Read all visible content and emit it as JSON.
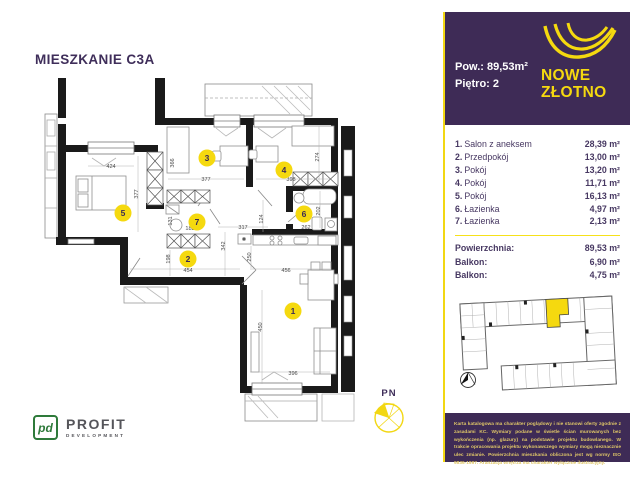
{
  "title": "MIESZKANIE C3A",
  "panel": {
    "header": {
      "area_line": "Pow.: 89,53m²",
      "floor_line": "Piętro: 2",
      "brand_line1": "NOWE",
      "brand_line2": "ZŁOTNO"
    },
    "rooms": [
      {
        "num": "1.",
        "name": "Salon z aneksem",
        "area": "28,39 m²"
      },
      {
        "num": "2.",
        "name": "Przedpokój",
        "area": "13,00 m²"
      },
      {
        "num": "3.",
        "name": "Pokój",
        "area": "13,20 m²"
      },
      {
        "num": "4.",
        "name": "Pokój",
        "area": "11,71 m²"
      },
      {
        "num": "5.",
        "name": "Pokój",
        "area": "16,13 m²"
      },
      {
        "num": "6.",
        "name": "Łazienka",
        "area": "4,97 m²"
      },
      {
        "num": "7.",
        "name": "Łazienka",
        "area": "2,13 m²"
      }
    ],
    "summary": [
      {
        "label": "Powierzchnia:",
        "value": "89,53 m²"
      },
      {
        "label": "Balkon:",
        "value": "6,90 m²"
      },
      {
        "label": "Balkon:",
        "value": "4,75 m²"
      }
    ],
    "disclaimer": "Karta katalogowa ma charakter poglądowy i nie stanowi oferty zgodnie z zasadami KC. Wymiary podane w świetle ścian murowanych bez wykończenia (np. glazury) na podstawie projektu budowlanego. W trakcie opracowania projektu wykonawczego wymiary mogą nieznacznie ulec zmianie. Powierzchnia mieszkania obliczona jest wg normy ISO 9836-1997. Aranżacja wnętrza ma charakter wyłącznie ilustracyjny."
  },
  "plan": {
    "room_markers": [
      {
        "n": "1",
        "x": 293,
        "y": 311
      },
      {
        "n": "2",
        "x": 188,
        "y": 259
      },
      {
        "n": "3",
        "x": 207,
        "y": 158
      },
      {
        "n": "4",
        "x": 284,
        "y": 170
      },
      {
        "n": "5",
        "x": 123,
        "y": 213
      },
      {
        "n": "6",
        "x": 304,
        "y": 214
      },
      {
        "n": "7",
        "x": 197,
        "y": 222
      }
    ],
    "dims": [
      {
        "t": "424",
        "x": 111,
        "y": 168
      },
      {
        "t": "377",
        "x": 138,
        "y": 194,
        "v": true
      },
      {
        "t": "366",
        "x": 174,
        "y": 163,
        "v": true
      },
      {
        "t": "377",
        "x": 206,
        "y": 181
      },
      {
        "t": "398",
        "x": 291,
        "y": 181
      },
      {
        "t": "274",
        "x": 319,
        "y": 157,
        "v": true
      },
      {
        "t": "131",
        "x": 172,
        "y": 221,
        "v": true
      },
      {
        "t": "182",
        "x": 190,
        "y": 230
      },
      {
        "t": "317",
        "x": 243,
        "y": 229
      },
      {
        "t": "124",
        "x": 263,
        "y": 219,
        "v": true
      },
      {
        "t": "342",
        "x": 225,
        "y": 246,
        "v": true
      },
      {
        "t": "198",
        "x": 170,
        "y": 259,
        "v": true
      },
      {
        "t": "454",
        "x": 188,
        "y": 272
      },
      {
        "t": "456",
        "x": 286,
        "y": 272
      },
      {
        "t": "250",
        "x": 251,
        "y": 257,
        "v": true
      },
      {
        "t": "450",
        "x": 262,
        "y": 327,
        "v": true
      },
      {
        "t": "396",
        "x": 293,
        "y": 375
      },
      {
        "t": "202",
        "x": 320,
        "y": 211,
        "v": true
      },
      {
        "t": "262",
        "x": 306,
        "y": 229
      }
    ]
  },
  "compass": {
    "label": "PN"
  },
  "logo": {
    "monogram": "pd",
    "name": "PROFIT",
    "subtitle": "DEVELOPMENT"
  },
  "colors": {
    "purple": "#3E2B56",
    "yellow": "#F5D90F"
  }
}
